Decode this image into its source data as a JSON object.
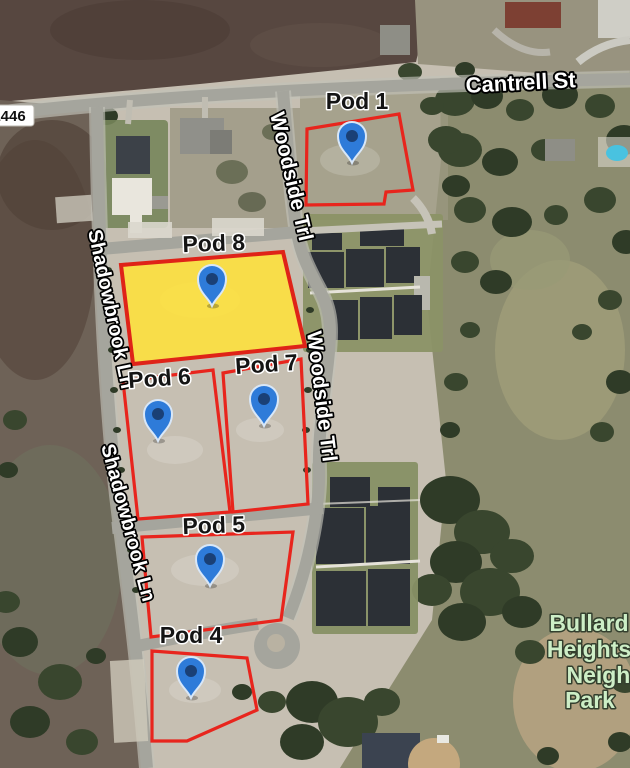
{
  "map": {
    "route_shield": {
      "label": "1446"
    },
    "streets": [
      {
        "id": "cantrell-st",
        "name": "Cantrell St"
      },
      {
        "id": "woodside-trl-north",
        "name": "Woodside Trl"
      },
      {
        "id": "woodside-trl-south",
        "name": "Woodside Trl"
      },
      {
        "id": "shadowbrook-ln-north",
        "name": "Shadowbrook Ln"
      },
      {
        "id": "shadowbrook-ln-south",
        "name": "Shadowbrook Ln"
      }
    ],
    "pods": [
      {
        "id": "pod-1",
        "label": "Pod 1",
        "highlighted": false,
        "has_pin": true
      },
      {
        "id": "pod-8",
        "label": "Pod 8",
        "highlighted": true,
        "has_pin": true
      },
      {
        "id": "pod-6",
        "label": "Pod 6",
        "highlighted": false,
        "has_pin": true
      },
      {
        "id": "pod-7",
        "label": "Pod 7",
        "highlighted": false,
        "has_pin": true
      },
      {
        "id": "pod-5",
        "label": "Pod 5",
        "highlighted": false,
        "has_pin": true
      },
      {
        "id": "pod-4",
        "label": "Pod 4",
        "highlighted": false,
        "has_pin": true
      }
    ],
    "park": {
      "lines": [
        "Bullard",
        "Heights",
        "Neighborho",
        "Park"
      ]
    },
    "colors": {
      "parcel_outline": "#e8251d",
      "highlight_fill": "#ffe13a",
      "pin_blue": "#2e7bd9",
      "pin_core": "#1a4076",
      "street_label": "#ffffff",
      "pod_label": "#141414",
      "park_label": "#cdeec6"
    }
  }
}
